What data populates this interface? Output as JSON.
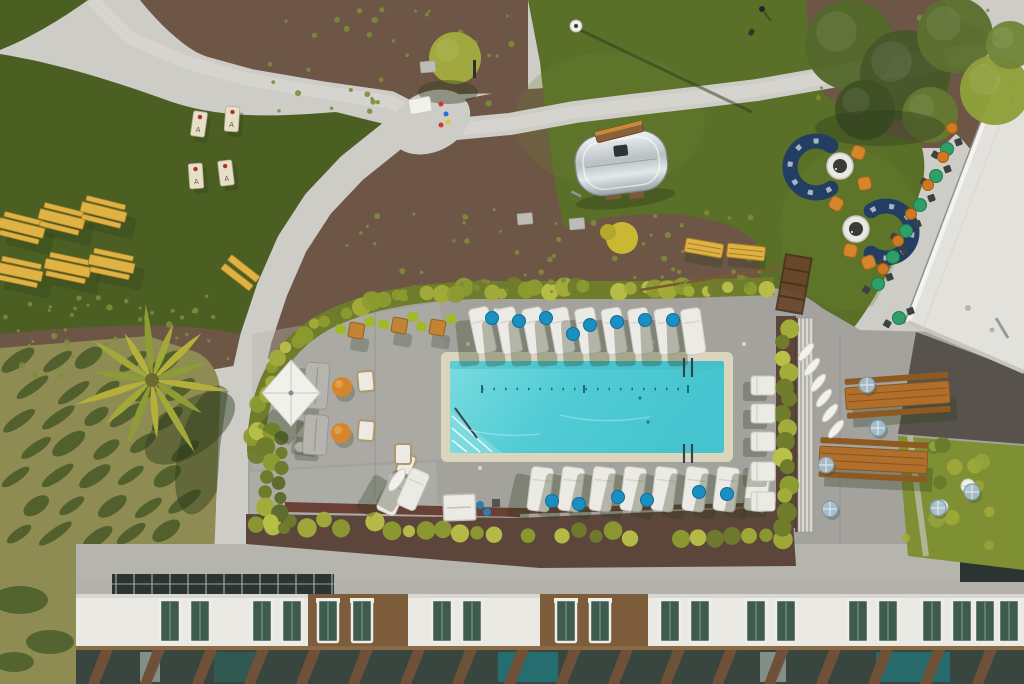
{
  "scene": {
    "type": "aerial-photograph",
    "subject": "hotel pool deck, lawn courtyard, Airstream trailer and building facade seen from above",
    "width": 1024,
    "height": 684
  },
  "labels": {
    "cornhole_letter": "A"
  },
  "palette": {
    "deck": "#a3a29d",
    "deckLight": "#b5b4ad",
    "path": "#cdccc6",
    "pathBright": "#dad9d3",
    "lawnDark": "#4c5f23",
    "lawnMid": "#5a7028",
    "lawnBright": "#6a812f",
    "hill": "#8e8c52",
    "hillDark": "#3c5222",
    "mulch": "#6e5647",
    "mulchDark": "#5c463b",
    "shrub": "#5f6c2e",
    "hedge": "#a2ac3a",
    "hedgeDark": "#6f7c2c",
    "hedgeLite": "#b9c048",
    "fence": "#4a3423",
    "fenceRed": "#6b4034",
    "water": "#5fd0d8",
    "waterDeep": "#3fbac6",
    "coping": "#dcd5bd",
    "woodYellow": "#e0b143",
    "woodYellowDark": "#a87f28",
    "woodOrange": "#b06f2a",
    "woodOrangeDark": "#8f5a22",
    "white": "#eceae5",
    "offWhite": "#d8d7d1",
    "sofaBlue": "#223f63",
    "orange": "#d5862b",
    "lime": "#9fb929",
    "cafeGreen": "#2f9e68",
    "chairDark": "#3c4241",
    "pillow": "#1a8fc1",
    "silver": "#c9ced1",
    "silverHi": "#eef1f2",
    "roof": "#e2e1dc",
    "roofEdge": "#f4f3ef",
    "bldgGray": "#b2b1ab",
    "bldgWhite": "#eae9e4",
    "bldgBrown": "#7c5c3b",
    "glass": "#3f5a4e",
    "glassDark": "#2b3430",
    "teal": "#1f7b80",
    "shadow": "#2c3b1c",
    "umbBlue": "#a9c3d2"
  },
  "objects": {
    "cornhole": [
      {
        "x": 199,
        "y": 124,
        "rot": 8
      },
      {
        "x": 232,
        "y": 119,
        "rot": 4
      },
      {
        "x": 196,
        "y": 176,
        "rot": -4
      },
      {
        "x": 226,
        "y": 173,
        "rot": -7
      }
    ],
    "picnic": [
      {
        "x": 22,
        "y": 226,
        "rot": 14
      },
      {
        "x": 62,
        "y": 217,
        "rot": 14
      },
      {
        "x": 104,
        "y": 210,
        "rot": 14
      },
      {
        "x": 20,
        "y": 270,
        "rot": 12
      },
      {
        "x": 68,
        "y": 266,
        "rot": 12
      },
      {
        "x": 112,
        "y": 262,
        "rot": 12
      }
    ],
    "benchPair": {
      "x": 241,
      "y": 272,
      "rot": 38
    },
    "lawnBenches": [
      {
        "x": 704,
        "y": 248,
        "rot": 10
      },
      {
        "x": 746,
        "y": 252,
        "rot": 6
      }
    ],
    "airstream": {
      "x": 572,
      "y": 139,
      "w": 92,
      "h": 60,
      "rot": -7
    },
    "airstreamBench": {
      "x": 620,
      "y": 138,
      "rot": -14
    },
    "lamp": {
      "x": 576,
      "y": 26,
      "sx": 752,
      "sy": 112
    },
    "person": {
      "x": 762,
      "y": 9
    },
    "dog": {
      "x": 751,
      "y": 28
    },
    "loungersTop": {
      "x0": 468,
      "step": 26.5,
      "count": 9,
      "y": 310,
      "rot": -12
    },
    "pillowsTop": [
      [
        492,
        318
      ],
      [
        519,
        321
      ],
      [
        546,
        318
      ],
      [
        573,
        334
      ],
      [
        590,
        325
      ],
      [
        617,
        322
      ],
      [
        645,
        320
      ],
      [
        673,
        320
      ]
    ],
    "loungersBottom": {
      "x0": 532,
      "step": 31,
      "count": 8,
      "y": 466,
      "rot": 7
    },
    "pillowsBottom": [
      [
        552,
        501
      ],
      [
        579,
        504
      ],
      [
        618,
        497
      ],
      [
        647,
        500
      ],
      [
        699,
        492
      ],
      [
        727,
        494
      ]
    ],
    "loungersLeftPair": [
      {
        "x": 392,
        "y": 472,
        "rot": 24
      },
      {
        "x": 412,
        "y": 467,
        "rot": 24
      }
    ],
    "loungersRight": {
      "x": 751,
      "ys": [
        376,
        404,
        432,
        462,
        492
      ]
    },
    "tableSets": [
      [
        356,
        330
      ],
      [
        399,
        325
      ],
      [
        437,
        327
      ]
    ],
    "cafeSets": [
      [
        947,
        149
      ],
      [
        936,
        176
      ],
      [
        920,
        205
      ],
      [
        906,
        231
      ],
      [
        893,
        257
      ],
      [
        878,
        284
      ],
      [
        899,
        318
      ]
    ],
    "orangeUmbrellas": [
      [
        952,
        128
      ],
      [
        943,
        157
      ],
      [
        928,
        185
      ],
      [
        911,
        214
      ],
      [
        898,
        241
      ],
      [
        883,
        269
      ]
    ],
    "whiteUmbrellas": [
      [
        806,
        352
      ],
      [
        812,
        367
      ],
      [
        818,
        383
      ],
      [
        824,
        398
      ],
      [
        830,
        413
      ],
      [
        836,
        429
      ]
    ],
    "blueUmbrellas": [
      [
        867,
        385
      ],
      [
        878,
        428
      ],
      [
        826,
        465
      ],
      [
        830,
        509
      ],
      [
        938,
        508
      ],
      [
        972,
        492
      ]
    ],
    "woodTables": [
      {
        "x": 845,
        "y": 388,
        "rot": -4,
        "len": 104
      },
      {
        "x": 820,
        "y": 446,
        "rot": 3,
        "len": 108
      }
    ],
    "sofasBlue": [
      {
        "cx": 816,
        "cy": 167,
        "r": 26,
        "a0": 55,
        "a1": 305
      },
      {
        "cx": 886,
        "cy": 232,
        "r": 26,
        "a0": -125,
        "a1": 125
      }
    ],
    "fireTables": [
      [
        840,
        166
      ],
      [
        856,
        229
      ]
    ],
    "orangeChairs": [
      [
        858,
        152,
        20
      ],
      [
        864,
        183,
        -10
      ],
      [
        836,
        203,
        30
      ],
      [
        850,
        250,
        10
      ],
      [
        868,
        262,
        -20
      ]
    ],
    "graySofas": [
      [
        306,
        362,
        24,
        46,
        4
      ],
      [
        305,
        414,
        24,
        40,
        4
      ]
    ],
    "poufs": [
      [
        342,
        387
      ],
      [
        341,
        433
      ]
    ],
    "armchairs": [
      [
        357,
        372,
        -5
      ],
      [
        359,
        420,
        5
      ],
      [
        402,
        452,
        20
      ],
      [
        395,
        444,
        0
      ]
    ],
    "umbrella": {
      "x": 291,
      "y": 393
    },
    "towelHut": {
      "x": 443,
      "y": 495
    },
    "bins": [
      [
        480,
        505
      ],
      [
        487,
        512
      ]
    ],
    "grill": {
      "x": 293,
      "y": 436
    },
    "whiteCart": [
      [
        494,
        308
      ]
    ],
    "canopyTent": {
      "x": 408,
      "y": 100
    },
    "playgroundDots": [
      [
        441,
        104,
        "#cf3a2a"
      ],
      [
        446,
        114,
        "#2a6fcf"
      ],
      [
        448,
        122,
        "#e8c32a"
      ],
      [
        441,
        125,
        "#cf3a2a"
      ]
    ],
    "stones": [
      [
        517,
        214
      ],
      [
        569,
        219
      ],
      [
        420,
        62
      ]
    ],
    "bush": {
      "x": 622,
      "y": 238
    },
    "drains": [
      [
        468,
        344
      ],
      [
        560,
        341
      ],
      [
        652,
        342
      ],
      [
        744,
        344
      ],
      [
        480,
        468
      ],
      [
        572,
        470
      ],
      [
        664,
        470
      ],
      [
        756,
        468
      ]
    ],
    "joints": [
      [
        375,
        300,
        375,
        498
      ],
      [
        610,
        290,
        610,
        350
      ],
      [
        610,
        463,
        610,
        502
      ],
      [
        840,
        336,
        840,
        552
      ],
      [
        700,
        290,
        700,
        348
      ]
    ],
    "windows": {
      "white": [
        160,
        252,
        432,
        660,
        746,
        848,
        922,
        975
      ],
      "brown": [
        318,
        556
      ]
    },
    "skylight": {
      "x": 112,
      "w": 222,
      "step": 18
    },
    "mullions": {
      "x0": 88,
      "step": 52,
      "count": 18
    },
    "palm": {
      "x": 152,
      "y": 380,
      "fronds": [
        78,
        60,
        84,
        58,
        72,
        64,
        80,
        58,
        70,
        54,
        76,
        60,
        68,
        56
      ]
    },
    "trees": [
      [
        850,
        45,
        45,
        "#55682b"
      ],
      [
        905,
        75,
        45,
        "#47582a"
      ],
      [
        955,
        35,
        38,
        "#5d7030"
      ],
      [
        865,
        110,
        30,
        "#3f5124"
      ],
      [
        995,
        90,
        35,
        "#8ea03a"
      ],
      [
        930,
        115,
        28,
        "#667832"
      ],
      [
        1010,
        45,
        24,
        "#72853a"
      ],
      [
        455,
        58,
        26,
        "#a3aa3f"
      ]
    ],
    "courtUmbrellas": [
      [
        968,
        486
      ],
      [
        941,
        507
      ]
    ],
    "bedDots": [
      [
        234,
        8,
        286,
        104,
        36
      ],
      [
        344,
        208,
        420,
        84,
        55
      ],
      [
        2,
        294,
        234,
        84,
        40
      ],
      [
        802,
        10,
        215,
        120,
        16
      ]
    ],
    "plantRow": {
      "x0": 256,
      "x1": 788,
      "step": 17,
      "y0": 522,
      "y1": 540
    },
    "shrubColumn": {
      "x": 272,
      "y0": 432,
      "y1": 536,
      "step": 15
    },
    "rightStrip": {
      "x": 786,
      "y0": 326,
      "y1": 524,
      "step": 14
    },
    "moss": {
      "x": 905,
      "y": 440,
      "w": 110,
      "h": 112,
      "count": 14
    }
  }
}
